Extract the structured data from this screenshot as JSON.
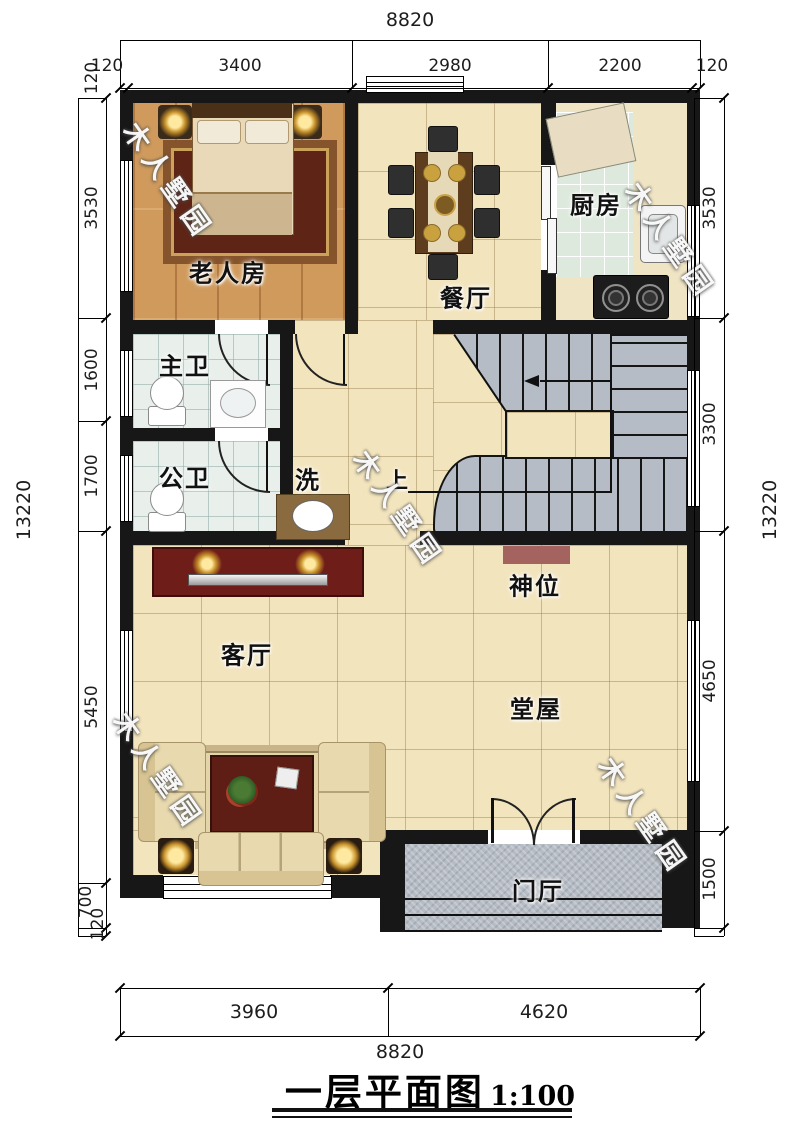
{
  "title": {
    "text": "一层平面图",
    "scale": "1:100"
  },
  "watermark": {
    "text": "木人墅园"
  },
  "rooms": {
    "elderly": "老人房",
    "dining": "餐厅",
    "kitchen": "厨房",
    "master_bath": "主卫",
    "public_bath": "公卫",
    "wash": "洗",
    "stair_up": "上",
    "shrine": "神位",
    "living": "客厅",
    "hall": "堂屋",
    "foyer": "门厅"
  },
  "dimensions": {
    "top": {
      "overall": "8820",
      "segments": [
        "120",
        "3400",
        "2980",
        "2200",
        "120"
      ]
    },
    "bottom": {
      "overall": "8820",
      "segments": [
        "3960",
        "4620"
      ]
    },
    "left": {
      "overall": "13220",
      "segments": [
        "120",
        "3530",
        "1600",
        "1700",
        "5450",
        "700",
        "120"
      ]
    },
    "right": {
      "overall": "13220",
      "segments": [
        "3530",
        "3300",
        "4650",
        "1500"
      ]
    }
  },
  "colors": {
    "wall": "#171717",
    "beige": "#f2e4bd",
    "wood": "#cf9a5c",
    "mint": "#dde9dd",
    "bathtile": "#e9f0ec",
    "granite": "#b6bcc5",
    "altar": "#a5635f",
    "cabinet": "#6e1d18",
    "sofa": "#e8d9ae",
    "gold": "#c9a23f"
  }
}
